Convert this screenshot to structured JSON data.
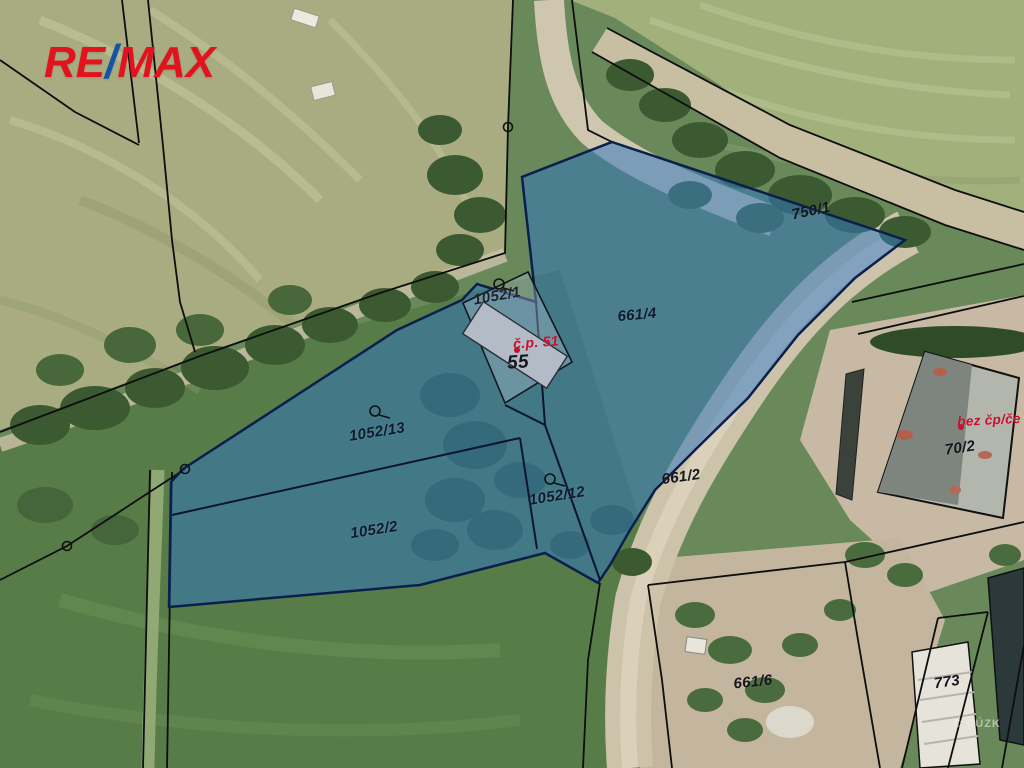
{
  "logo": {
    "re": "RE",
    "slash": "/",
    "max": "MAX",
    "red": "#e2131f",
    "blue": "#1553a5"
  },
  "map": {
    "highlight_fill": "#2f77c0",
    "boundary_color": "#0e0e0e",
    "parcel_line_color": "#0c1530",
    "red_label_color": "#c8102e",
    "dark_label_color": "#14161f",
    "watermark": "© ČÚZK",
    "parcel_labels": [
      {
        "text": "1052/1"
      },
      {
        "text": "661/4"
      },
      {
        "text": "750/1"
      },
      {
        "text": "1052/13"
      },
      {
        "text": "1052/2"
      },
      {
        "text": "1052/12"
      },
      {
        "text": "661/2"
      },
      {
        "text": "70/2"
      },
      {
        "text": "661/6"
      },
      {
        "text": "773"
      }
    ],
    "building_labels": [
      {
        "text": "č.p. 51",
        "color": "#c8102e"
      },
      {
        "text": "55",
        "color": "#15161f"
      },
      {
        "text": "bez čp/če",
        "color": "#c8102e"
      }
    ]
  }
}
